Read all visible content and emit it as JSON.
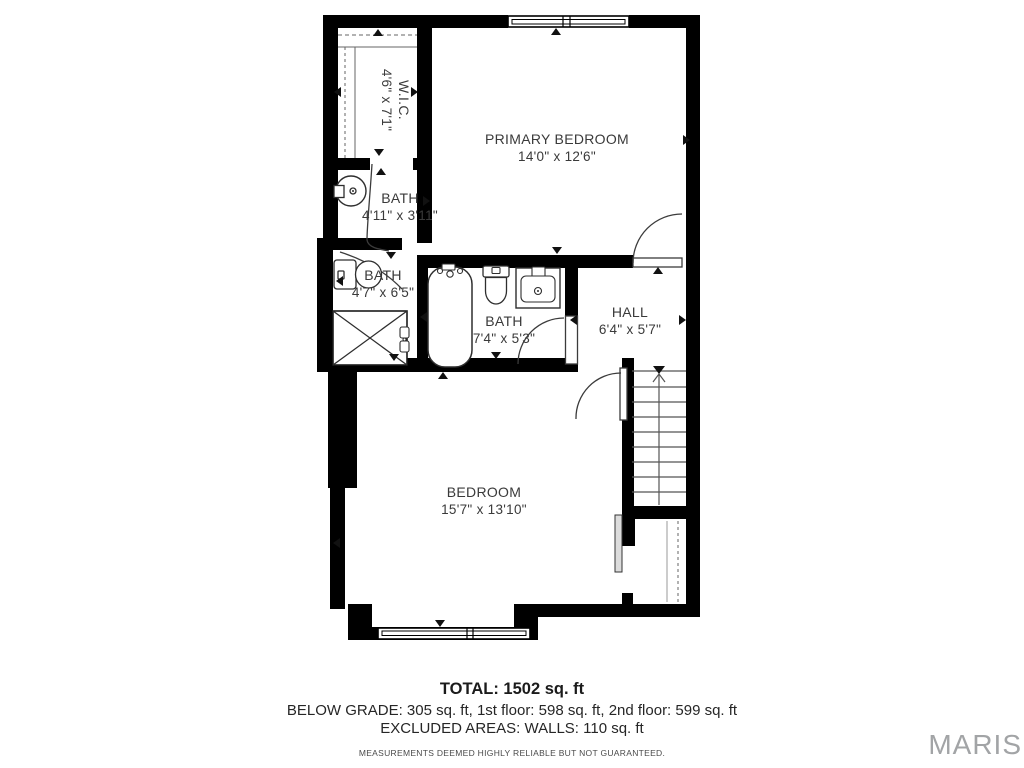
{
  "plan": {
    "rooms": [
      {
        "name": "W.I.C.",
        "dims": "4'6\" x 7'1\""
      },
      {
        "name": "BATH",
        "dims": "4'11\" x 3'11\""
      },
      {
        "name": "PRIMARY BEDROOM",
        "dims": "14'0\" x 12'6\""
      },
      {
        "name": "BATH",
        "dims": "4'7\" x 6'5\""
      },
      {
        "name": "BATH",
        "dims": "7'4\" x 5'3\""
      },
      {
        "name": "HALL",
        "dims": "6'4\" x 5'7\""
      },
      {
        "name": "BEDROOM",
        "dims": "15'7\" x 13'10\""
      }
    ],
    "footer": {
      "total": "TOTAL: 1502 sq. ft",
      "breakdown": "BELOW GRADE: 305 sq. ft, 1st floor: 598 sq. ft, 2nd floor: 599 sq. ft",
      "excluded": "EXCLUDED AREAS: WALLS: 110 sq. ft",
      "disclaimer": "MEASUREMENTS DEEMED HIGHLY RELIABLE BUT NOT GUARANTEED."
    },
    "watermark": "MARIS",
    "colors": {
      "wall": "#000000",
      "text": "#3a3a3a",
      "watermark": "#a2a4a6"
    }
  }
}
